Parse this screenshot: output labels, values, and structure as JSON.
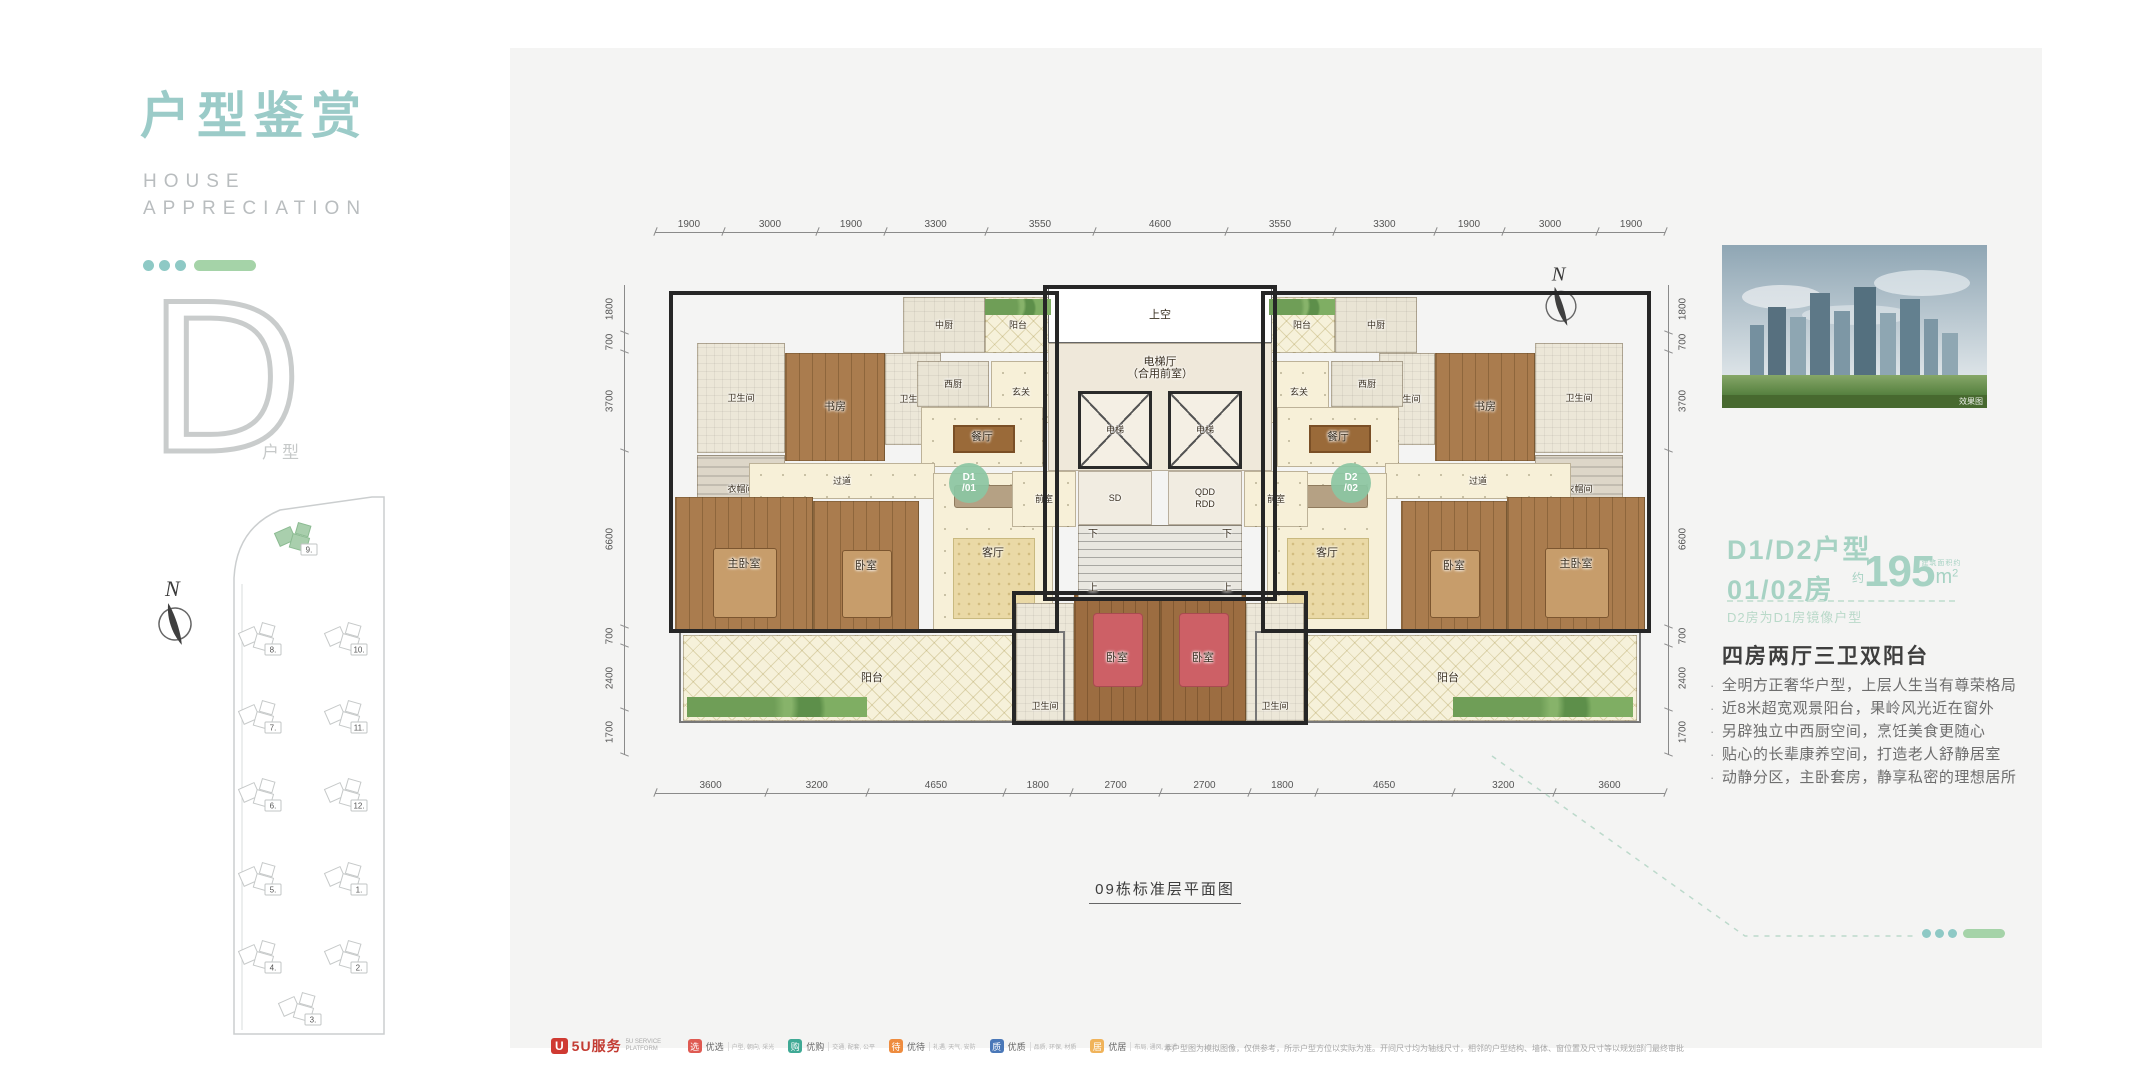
{
  "colors": {
    "accent_teal": "#9bcbc8",
    "accent_green": "#a5d3a8",
    "panel_bg": "#f4f4f3",
    "badge_green": "#8bc5a3"
  },
  "sidebar": {
    "title": "户型鉴赏",
    "subtitle_lines": [
      "HOUSE",
      "APPRECIATION"
    ],
    "letter": "D",
    "letter_label": "户型",
    "compass_label": "N",
    "sitemap": {
      "buildings": [
        {
          "n": "9.",
          "x": 72,
          "y": 46,
          "green": true
        },
        {
          "n": "8.",
          "x": 36,
          "y": 146
        },
        {
          "n": "7.",
          "x": 36,
          "y": 224
        },
        {
          "n": "6.",
          "x": 36,
          "y": 302
        },
        {
          "n": "5.",
          "x": 36,
          "y": 386
        },
        {
          "n": "4.",
          "x": 36,
          "y": 464
        },
        {
          "n": "10.",
          "x": 122,
          "y": 146
        },
        {
          "n": "11.",
          "x": 122,
          "y": 224
        },
        {
          "n": "12.",
          "x": 122,
          "y": 302
        },
        {
          "n": "1.",
          "x": 122,
          "y": 386
        },
        {
          "n": "2.",
          "x": 122,
          "y": 464
        },
        {
          "n": "3.",
          "x": 76,
          "y": 516
        }
      ]
    }
  },
  "plan": {
    "caption": "09栋标准层平面图",
    "compass_label": "N",
    "dims": {
      "top": [
        1900,
        3000,
        1900,
        3300,
        3550,
        4600,
        3550,
        3300,
        1900,
        3000,
        1900
      ],
      "bottom": [
        3600,
        3200,
        4650,
        1800,
        2700,
        2700,
        1800,
        4650,
        3200,
        3600
      ],
      "left": [
        1800,
        700,
        3700,
        6600,
        700,
        2400,
        1700
      ],
      "right": [
        1800,
        700,
        3700,
        6600,
        700,
        2400,
        1700
      ]
    },
    "rooms": [
      {
        "t": "balcony",
        "l": "阳台",
        "x": 28,
        "y": 350,
        "w": 378,
        "h": 86
      },
      {
        "t": "balcony",
        "l": "阳台",
        "x": 604,
        "y": 350,
        "w": 378,
        "h": 86
      },
      {
        "t": "bath",
        "l": "卫生间",
        "x": 42,
        "y": 58,
        "w": 88,
        "h": 110,
        "s": 1
      },
      {
        "t": "study",
        "l": "书房",
        "x": 130,
        "y": 68,
        "w": 100,
        "h": 108
      },
      {
        "t": "bath",
        "l": "卫生间",
        "x": 230,
        "y": 68,
        "w": 56,
        "h": 92,
        "s": 1
      },
      {
        "t": "kitchen",
        "l": "中厨",
        "x": 248,
        "y": 12,
        "w": 82,
        "h": 56,
        "s": 1
      },
      {
        "t": "balcony",
        "l": "阳台",
        "x": 330,
        "y": 12,
        "w": 66,
        "h": 56,
        "s": 1
      },
      {
        "t": "kitchen",
        "l": "西厨",
        "x": 262,
        "y": 76,
        "w": 72,
        "h": 46,
        "s": 1
      },
      {
        "t": "foyer",
        "l": "玄关",
        "x": 336,
        "y": 76,
        "w": 60,
        "h": 62,
        "s": 1
      },
      {
        "t": "dining",
        "l": "餐厅",
        "x": 266,
        "y": 122,
        "w": 122,
        "h": 60
      },
      {
        "t": "closet",
        "l": "衣帽间",
        "x": 42,
        "y": 170,
        "w": 88,
        "h": 68,
        "s": 1
      },
      {
        "t": "corridor",
        "l": "过道",
        "x": 94,
        "y": 178,
        "w": 186,
        "h": 36,
        "s": 1
      },
      {
        "t": "master",
        "l": "主卧室",
        "x": 20,
        "y": 212,
        "w": 138,
        "h": 134
      },
      {
        "t": "bedroom",
        "l": "卧室",
        "x": 158,
        "y": 216,
        "w": 106,
        "h": 130
      },
      {
        "t": "living",
        "l": "客厅",
        "x": 278,
        "y": 188,
        "w": 120,
        "h": 160
      },
      {
        "t": "badge",
        "l": "D1\n/01",
        "x": 294,
        "y": 178,
        "w": 40,
        "h": 40
      },
      {
        "t": "bath",
        "l": "卫生间",
        "x": 880,
        "y": 58,
        "w": 88,
        "h": 110,
        "s": 1
      },
      {
        "t": "study",
        "l": "书房",
        "x": 780,
        "y": 68,
        "w": 100,
        "h": 108
      },
      {
        "t": "bath",
        "l": "卫生间",
        "x": 724,
        "y": 68,
        "w": 56,
        "h": 92,
        "s": 1
      },
      {
        "t": "kitchen",
        "l": "中厨",
        "x": 680,
        "y": 12,
        "w": 82,
        "h": 56,
        "s": 1
      },
      {
        "t": "balcony",
        "l": "阳台",
        "x": 614,
        "y": 12,
        "w": 66,
        "h": 56,
        "s": 1
      },
      {
        "t": "kitchen",
        "l": "西厨",
        "x": 676,
        "y": 76,
        "w": 72,
        "h": 46,
        "s": 1
      },
      {
        "t": "foyer",
        "l": "玄关",
        "x": 614,
        "y": 76,
        "w": 60,
        "h": 62,
        "s": 1
      },
      {
        "t": "dining",
        "l": "餐厅",
        "x": 622,
        "y": 122,
        "w": 122,
        "h": 60
      },
      {
        "t": "closet",
        "l": "衣帽间",
        "x": 880,
        "y": 170,
        "w": 88,
        "h": 68,
        "s": 1
      },
      {
        "t": "corridor",
        "l": "过道",
        "x": 730,
        "y": 178,
        "w": 186,
        "h": 36,
        "s": 1
      },
      {
        "t": "master",
        "l": "主卧室",
        "x": 852,
        "y": 212,
        "w": 138,
        "h": 134
      },
      {
        "t": "bedroom",
        "l": "卧室",
        "x": 746,
        "y": 216,
        "w": 106,
        "h": 130
      },
      {
        "t": "living",
        "l": "客厅",
        "x": 612,
        "y": 188,
        "w": 120,
        "h": 160
      },
      {
        "t": "badge",
        "l": "D2\n/02",
        "x": 676,
        "y": 178,
        "w": 40,
        "h": 40
      },
      {
        "t": "void",
        "l": "上空",
        "x": 393,
        "y": 2,
        "w": 224,
        "h": 56
      },
      {
        "t": "core",
        "l": "电梯厅\n（合用前室）",
        "x": 393,
        "y": 58,
        "w": 224,
        "h": 128,
        "lp": "top"
      },
      {
        "t": "elevator",
        "l": "电梯",
        "x": 423,
        "y": 106,
        "w": 74,
        "h": 78,
        "s": 1
      },
      {
        "t": "elevator",
        "l": "电梯",
        "x": 513,
        "y": 106,
        "w": 74,
        "h": 78,
        "s": 1
      },
      {
        "t": "lobby",
        "l": "前室",
        "x": 357,
        "y": 186,
        "w": 64,
        "h": 56,
        "s": 1
      },
      {
        "t": "service",
        "l": "SD",
        "x": 423,
        "y": 186,
        "w": 74,
        "h": 54,
        "s": 1
      },
      {
        "t": "service",
        "l": "QDD\nRDD",
        "x": 513,
        "y": 186,
        "w": 74,
        "h": 54,
        "s": 1
      },
      {
        "t": "lobby",
        "l": "前室",
        "x": 589,
        "y": 186,
        "w": 64,
        "h": 56,
        "s": 1
      },
      {
        "t": "stair",
        "x": 423,
        "y": 240,
        "w": 164,
        "h": 74
      },
      {
        "t": "text",
        "l": "下",
        "x": 427,
        "y": 242,
        "w": 22,
        "h": 16
      },
      {
        "t": "text",
        "l": "下",
        "x": 561,
        "y": 242,
        "w": 22,
        "h": 16
      },
      {
        "t": "text",
        "l": "上",
        "x": 427,
        "y": 296,
        "w": 22,
        "h": 16
      },
      {
        "t": "text",
        "l": "上",
        "x": 561,
        "y": 296,
        "w": 22,
        "h": 16
      },
      {
        "t": "bath",
        "l": "卫生间",
        "x": 361,
        "y": 318,
        "w": 58,
        "h": 118,
        "s": 1,
        "lp": "bottom"
      },
      {
        "t": "bedroom-s",
        "l": "卧室",
        "x": 419,
        "y": 310,
        "w": 86,
        "h": 126
      },
      {
        "t": "bedroom-s",
        "l": "卧室",
        "x": 505,
        "y": 310,
        "w": 86,
        "h": 126
      },
      {
        "t": "bath",
        "l": "卫生间",
        "x": 591,
        "y": 318,
        "w": 58,
        "h": 118,
        "s": 1,
        "lp": "bottom"
      },
      {
        "t": "plants",
        "x": 330,
        "y": 14,
        "w": 66,
        "h": 16
      },
      {
        "t": "plants",
        "x": 614,
        "y": 14,
        "w": 66,
        "h": 16
      },
      {
        "t": "plants",
        "x": 32,
        "y": 412,
        "w": 180,
        "h": 20
      },
      {
        "t": "plants",
        "x": 798,
        "y": 412,
        "w": 180,
        "h": 20
      },
      {
        "t": "shell",
        "x": 14,
        "y": 6,
        "w": 390,
        "h": 342
      },
      {
        "t": "shell",
        "x": 606,
        "y": 6,
        "w": 390,
        "h": 342
      },
      {
        "t": "shell",
        "x": 388,
        "y": 0,
        "w": 234,
        "h": 316
      },
      {
        "t": "shell",
        "x": 357,
        "y": 306,
        "w": 296,
        "h": 134
      },
      {
        "t": "shell-light",
        "x": 24,
        "y": 346,
        "w": 386,
        "h": 92
      },
      {
        "t": "shell-light",
        "x": 600,
        "y": 346,
        "w": 386,
        "h": 92
      }
    ]
  },
  "right_panel": {
    "photo_caption": "效果图",
    "title_line1": "D1/D2户型",
    "title_line2": "01/02房",
    "area_prefix": "约",
    "area_value": "195",
    "area_unit": "m",
    "area_sup": "2",
    "area_note": "建筑面积约",
    "mirror_note": "D2房为D1房镜像户型",
    "feature_title": "四房两厅三卫双阳台",
    "features": [
      "全明方正奢华户型，上层人生当有尊荣格局",
      "近8米超宽观景阳台，果岭风光近在窗外",
      "另辟独立中西厨空间，烹饪美食更随心",
      "贴心的长辈康养空间，打造老人舒静居室",
      "动静分区，主卧套房，静享私密的理想居所"
    ]
  },
  "footer": {
    "logo_mark": "U",
    "logo_text": "5U服务",
    "logo_sub": "5U SERVICE PLATFORM",
    "badges": [
      {
        "label": "优选",
        "icon": "选",
        "desc": "户型, 朝向, 采光",
        "color": "#df5a52"
      },
      {
        "label": "优购",
        "icon": "购",
        "desc": "交通, 配套, 公平",
        "color": "#3fa995"
      },
      {
        "label": "优待",
        "icon": "待",
        "desc": "礼遇, 天气, 安防",
        "color": "#ee8c3f"
      },
      {
        "label": "优质",
        "icon": "质",
        "desc": "品质, 环保, 材质",
        "color": "#4a78b8"
      },
      {
        "label": "优居",
        "icon": "居",
        "desc": "布局, 通风, 舒适",
        "color": "#f0b35a"
      }
    ],
    "disclaimer": "本户型图为模拟图像，仅供参考，所示户型方位以实际为准。开间尺寸均为轴线尺寸，相邻的户型结构、墙体、窗位置及尺寸等以规划部门最终审批图纸及实际交付为准。本资料不构成合同要约内容，买卖双方的权利义务以双方签订的《商品房买卖合同》及其补充协议约定为准。"
  }
}
